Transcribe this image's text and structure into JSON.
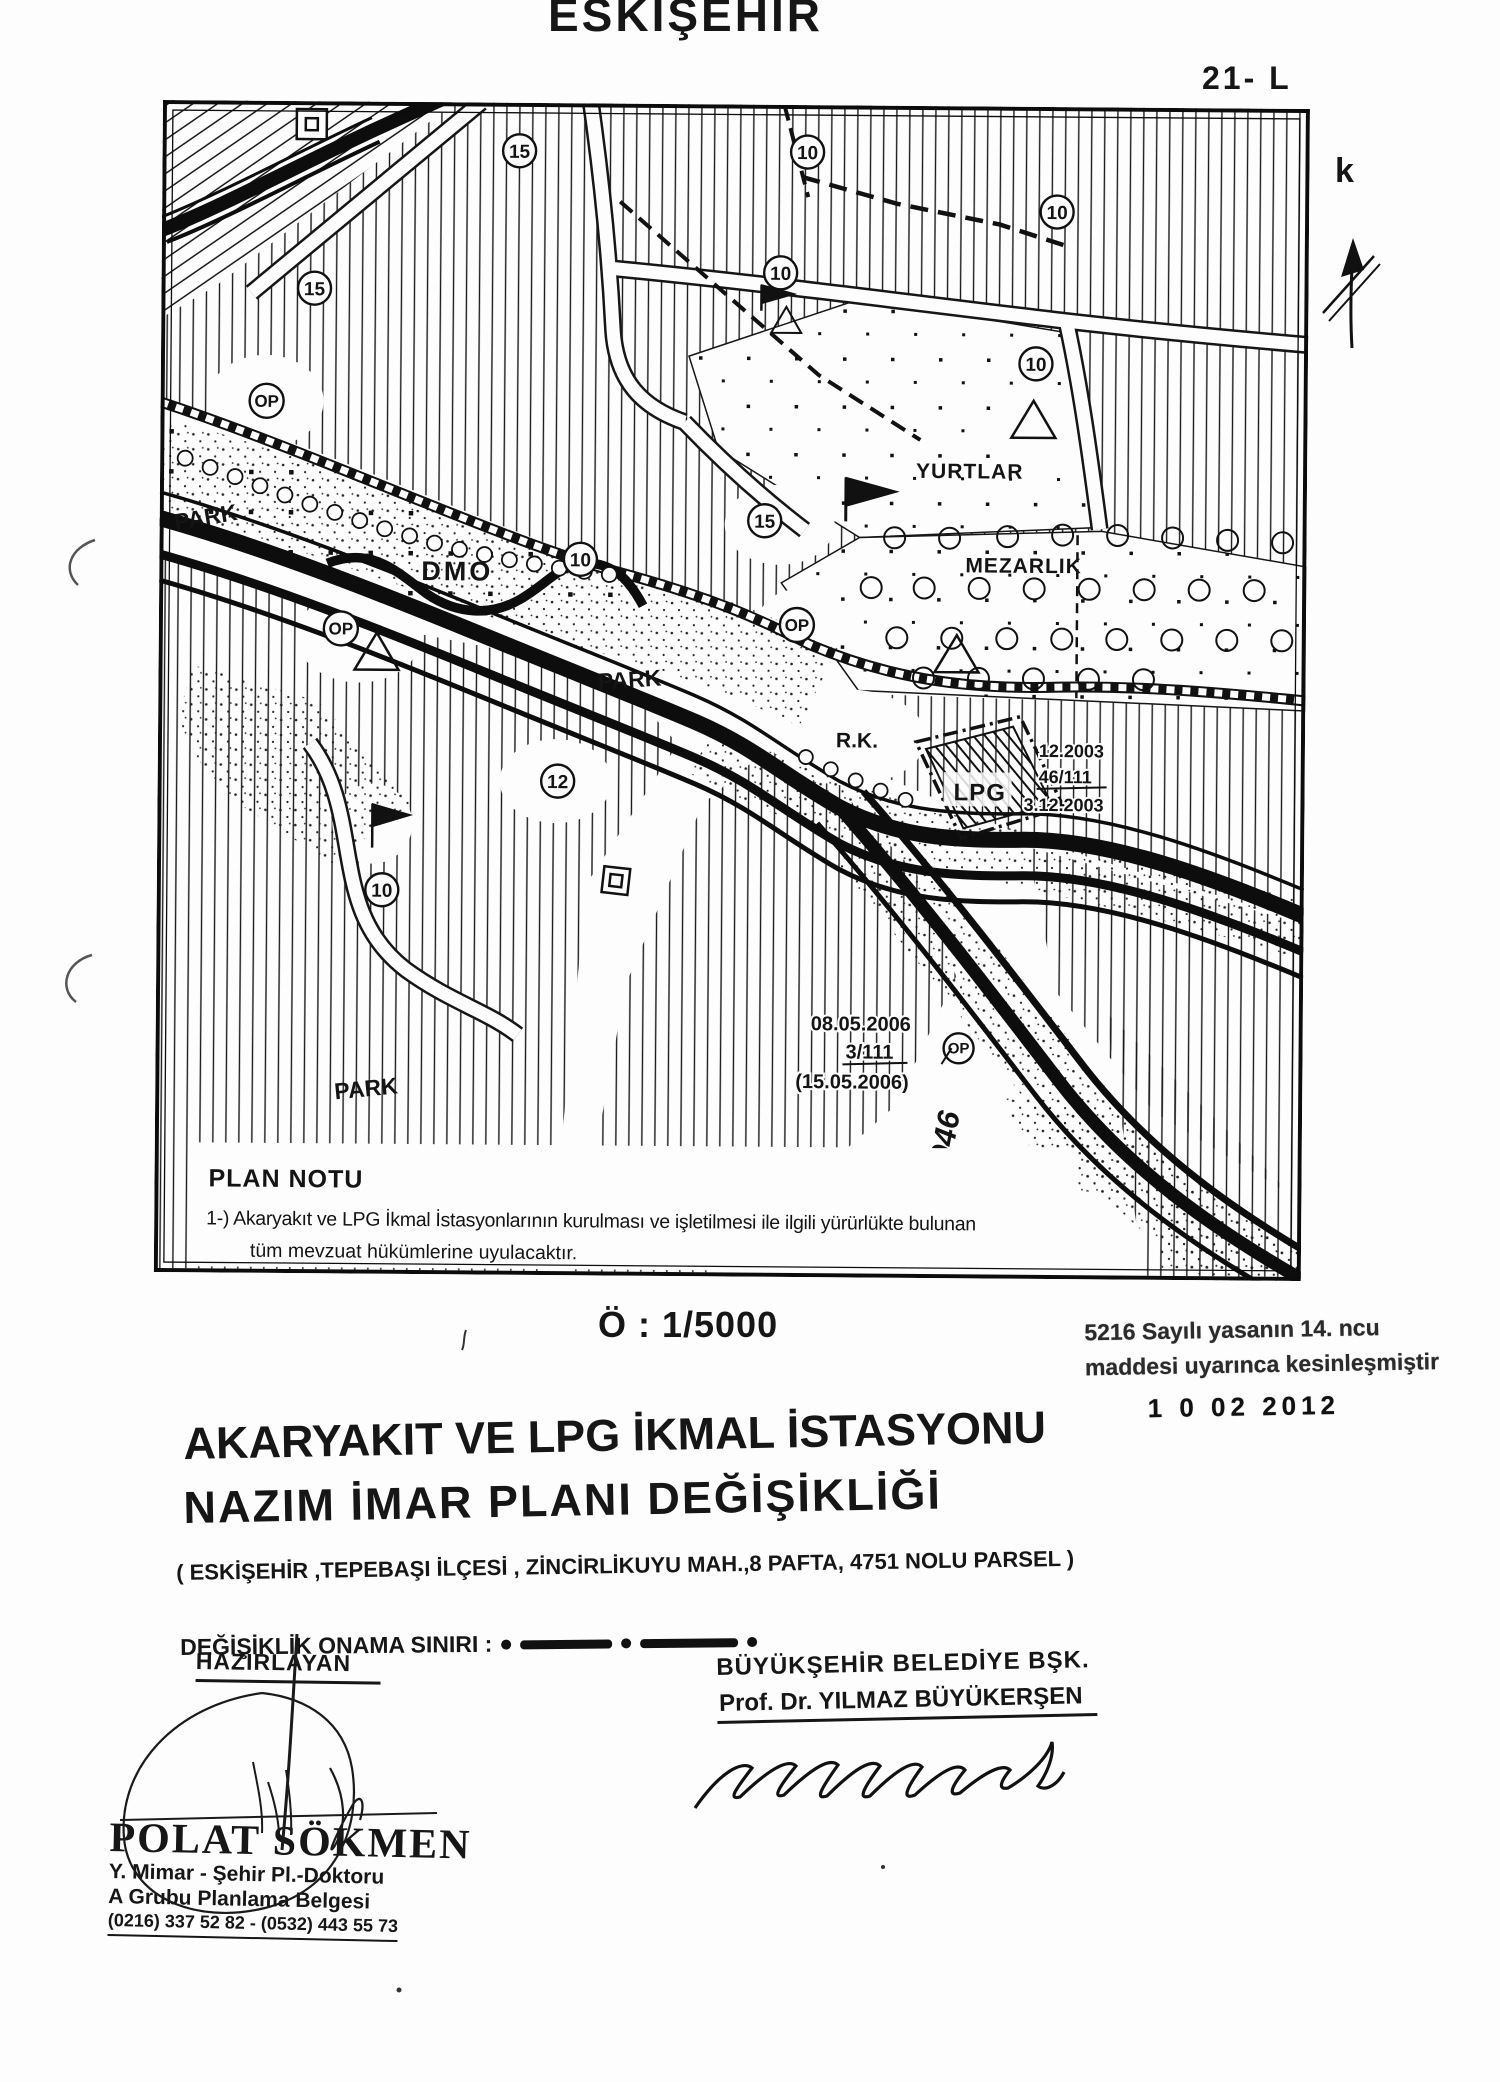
{
  "header": {
    "city_title": "ESKİŞEHİR",
    "sheet_label": "21- L",
    "north_letter": "k"
  },
  "map": {
    "labels": {
      "op": "OP",
      "dmo": "DMO",
      "park": "PARK",
      "yurtlar": "YURTLAR",
      "mezarlik": "MEZARLIK",
      "rk": "R.K.",
      "lpg": "LPG",
      "road_no": "946"
    },
    "circled": {
      "n10": "10",
      "n12": "12",
      "n15": "15"
    },
    "lpg_decision": {
      "date_top": "12.2003",
      "ref": "46/111",
      "date_bottom": "3.12.2003"
    },
    "plan_decision": {
      "date_top": "08.05.2006",
      "ref": "3/111",
      "date_bottom": "(15.05.2006)"
    },
    "plan_note": {
      "heading": "PLAN NOTU",
      "line1": "1-) Akaryakıt ve LPG İkmal İstasyonlarının kurulması ve işletilmesi ile ilgili yürürlükte bulunan",
      "line2": "tüm mevzuat hükümlerine uyulacaktır."
    }
  },
  "scale_label": "Ö : 1/5000",
  "approval_stamp": {
    "line1": "5216 Sayılı yasanın 14. ncu",
    "line2": "maddesi uyarınca kesinleşmiştir",
    "date": "1 0  02  2012"
  },
  "title_block": {
    "line1": "AKARYAKIT VE LPG İKMAL İSTASYONU",
    "line2": "NAZIM İMAR PLANI DEĞİŞİKLİĞİ",
    "subtitle": "( ESKİŞEHİR ,TEPEBAŞI İLÇESİ , ZİNCİRLİKUYU  MAH.,8 PAFTA, 4751 NOLU  PARSEL )",
    "legend_label": "DEĞİŞİKLİK ONAMA SINIRI :"
  },
  "prepared_by": {
    "heading": "HAZIRLAYAN",
    "name": "POLAT SÖKMEN",
    "line1": "Y. Mimar - Şehir Pl.-Doktoru",
    "line2": "A Grubu Planlama Belgesi",
    "line3": "(0216) 337 52 82  -  (0532) 443 55 73"
  },
  "approved_by": {
    "line1": "BÜYÜKŞEHİR  BELEDİYE  BŞK.",
    "line2": "Prof. Dr. YILMAZ BÜYÜKERŞEN"
  },
  "colors": {
    "ink": "#161616",
    "paper": "#fdfdfd"
  }
}
